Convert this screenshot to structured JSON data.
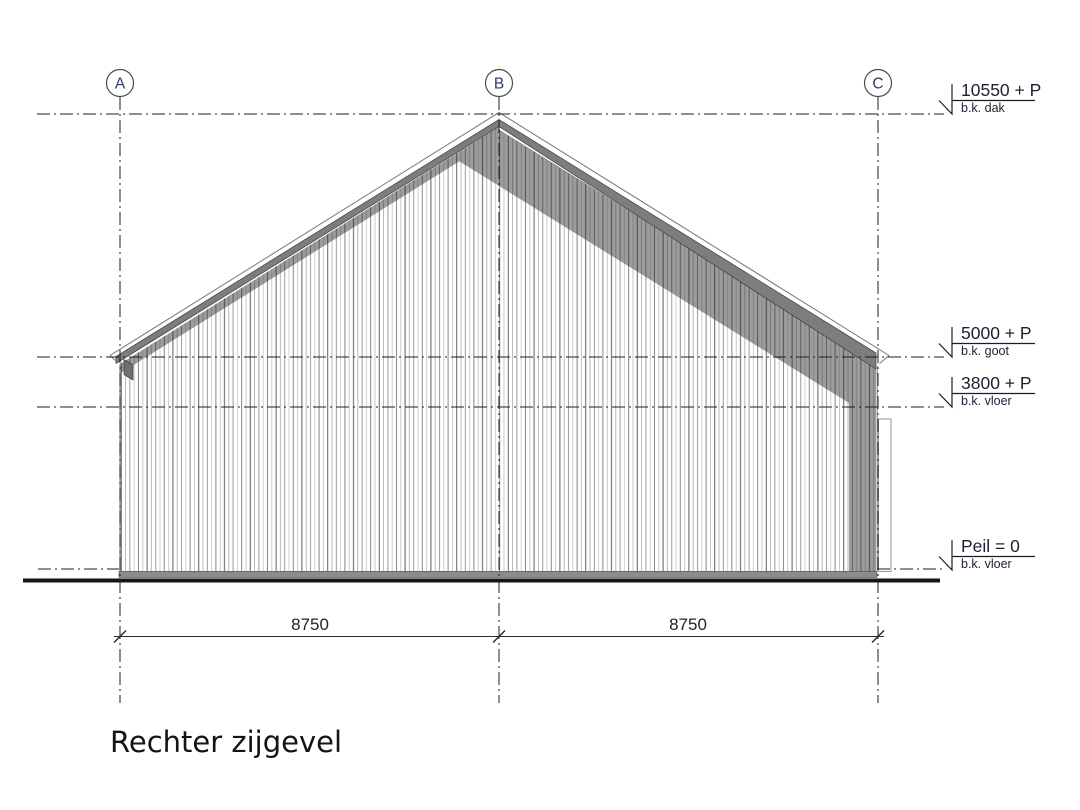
{
  "drawing": {
    "title": "Rechter zijgevel",
    "grid_bubbles": [
      {
        "label": "A"
      },
      {
        "label": "B"
      },
      {
        "label": "C"
      }
    ],
    "levels": [
      {
        "value": "10550 + P",
        "label": "b.k. dak"
      },
      {
        "value": "5000 + P",
        "label": "b.k. goot"
      },
      {
        "value": "3800 + P",
        "label": "b.k. vloer"
      },
      {
        "value": "Peil = 0",
        "label": "b.k. vloer"
      }
    ],
    "dimensions": [
      {
        "value": "8750"
      },
      {
        "value": "8750"
      }
    ],
    "colors": {
      "fascia": "#7d7d7d",
      "shadow_band": "#9c9c9c",
      "hatch_line": "#8f8f8f",
      "plinth": "#8c8c8c",
      "ground": "#151515",
      "line": "#1c1c1c",
      "grid_letter": "#2d3a6b",
      "background": "#ffffff"
    }
  }
}
